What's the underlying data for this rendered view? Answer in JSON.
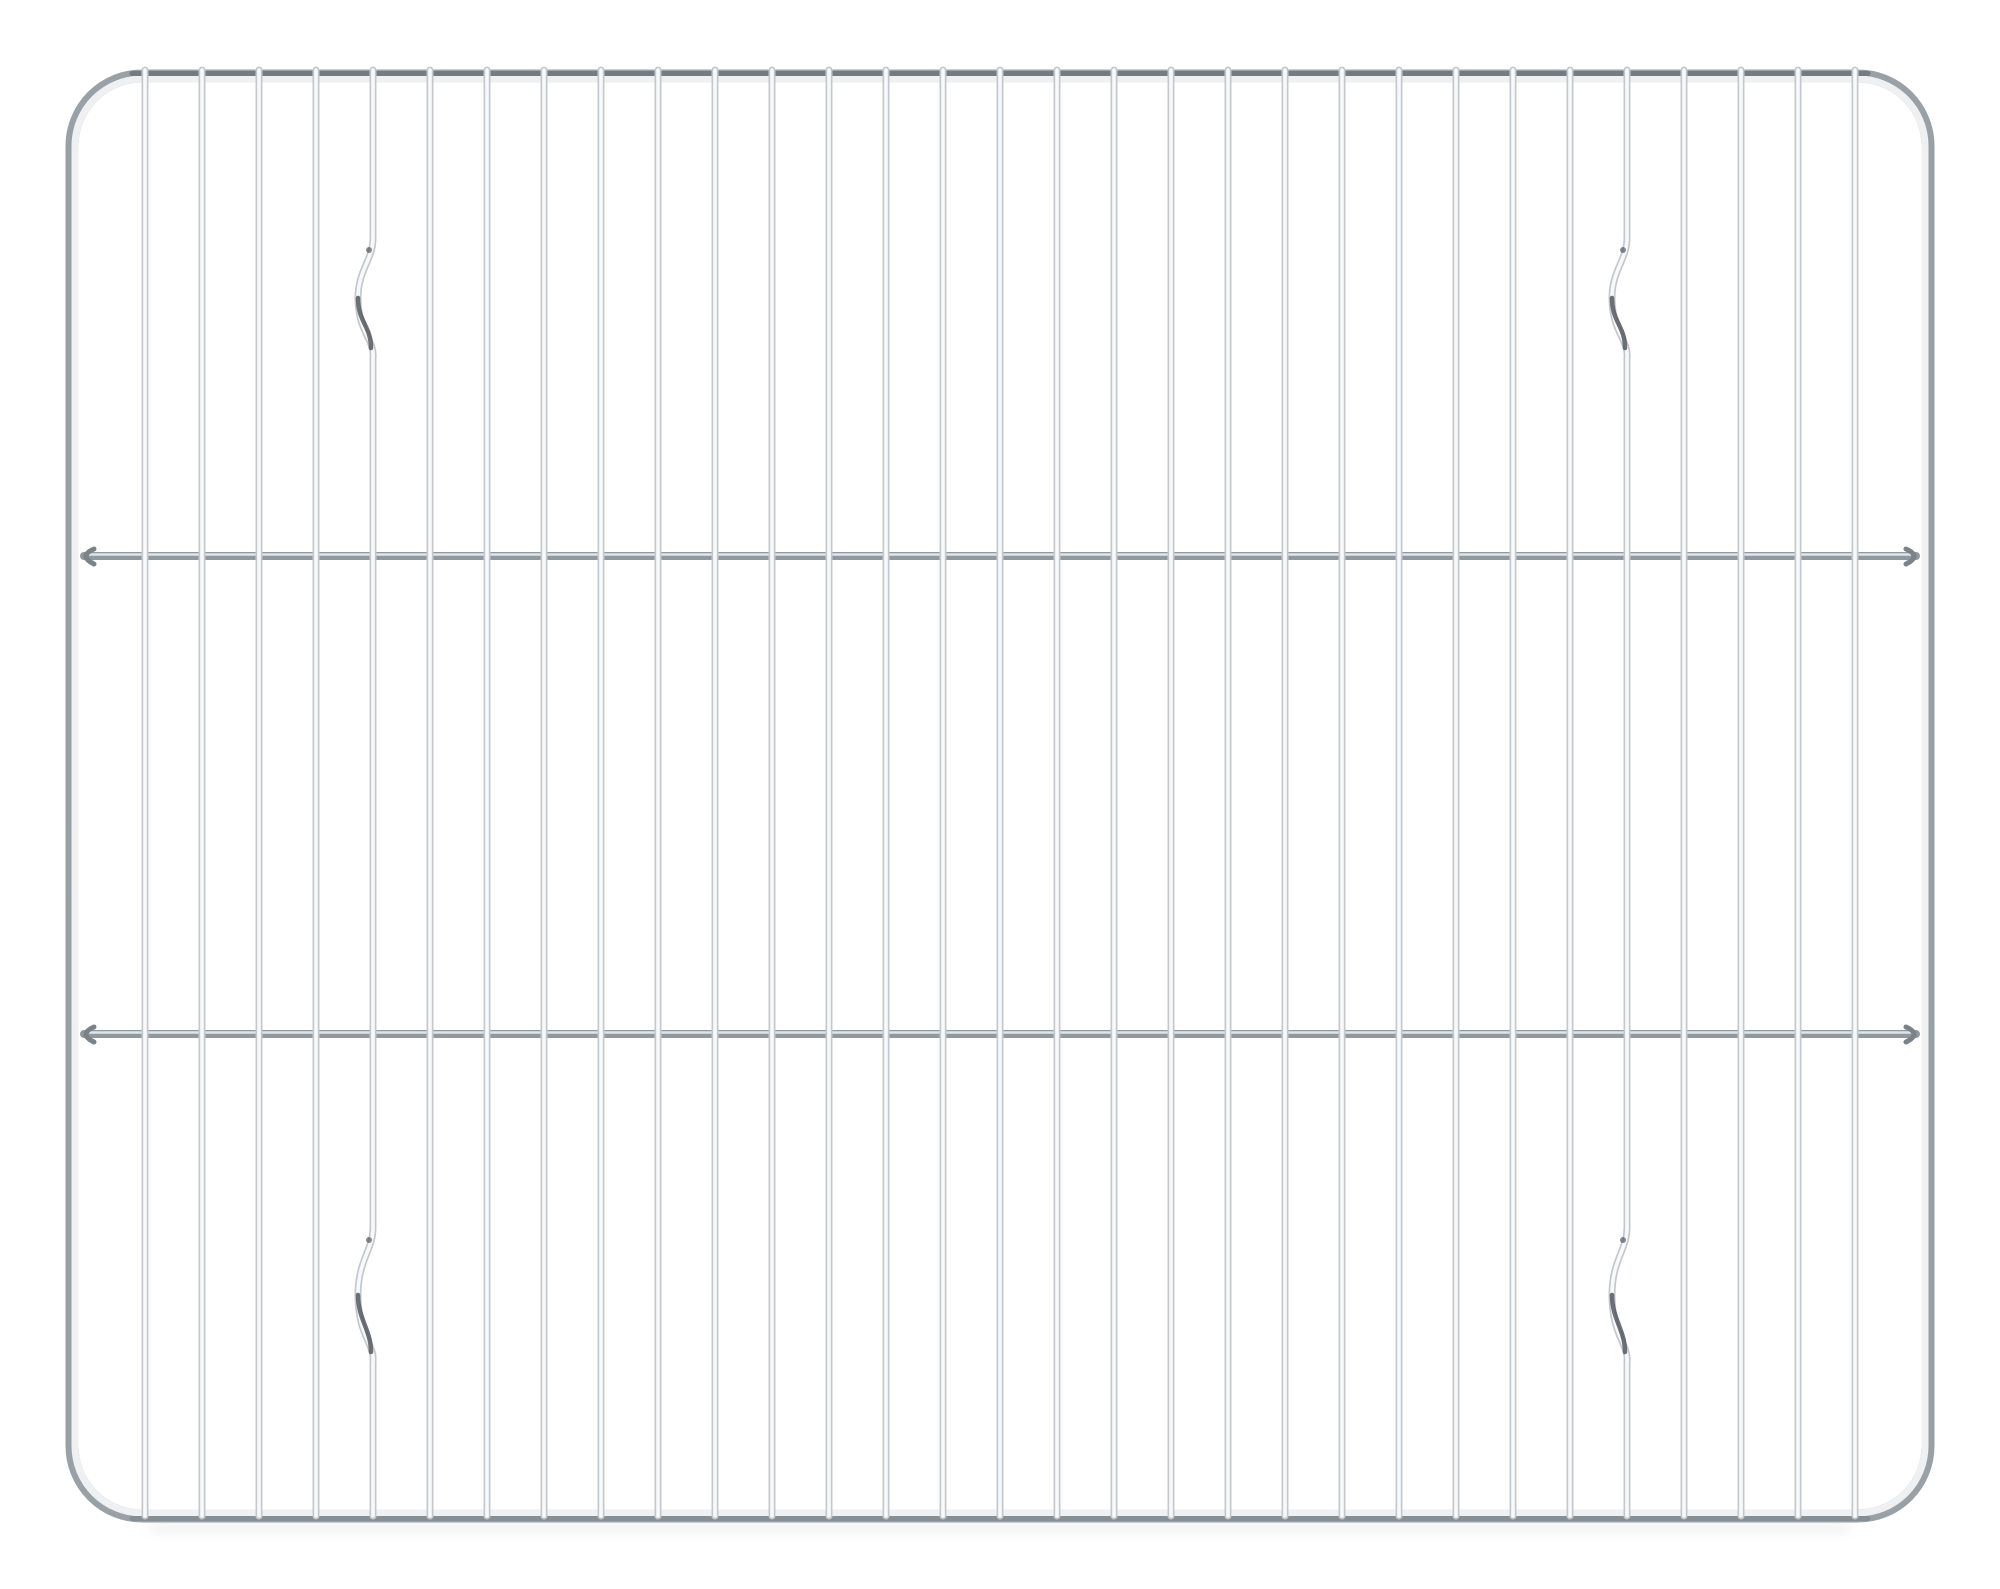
{
  "photo": {
    "subject": "chrome-wire-cooling-rack",
    "background_color": "#ffffff",
    "canvas": {
      "width": 2000,
      "height": 1589
    },
    "frame": {
      "x": 72,
      "y": 76,
      "w": 1856,
      "h": 1440,
      "radius": 70,
      "outer_color": "#99a0a6",
      "outer_width": 13,
      "inner_color": "#eef0f2",
      "inner_width": 7,
      "top_rim_color": "#747b82",
      "top_rim_width": 5,
      "top_rim_y": 73.5,
      "bottom_rim_color": "#878e94",
      "bottom_rim_width": 5,
      "bottom_rim_y": 1518.5,
      "rim_x1": 132,
      "rim_x2": 1868
    },
    "vertical_wires": {
      "count": 31,
      "first_x": 145,
      "spacing": 57,
      "top_y": 70,
      "bottom_y": 1516,
      "edge_color": "#c4c8cc",
      "edge_width": 7,
      "core_color": "#f8f9fa",
      "core_width": 3.6,
      "kinked_indices": [
        4,
        26
      ],
      "kink_top": {
        "start": 238,
        "end": 358,
        "depth": 15
      },
      "kink_bottom": {
        "start": 1228,
        "end": 1362,
        "depth": 15
      },
      "kink_glint_color": "#53585e",
      "kink_glint_width": 4.5
    },
    "crossbars": {
      "ys": [
        556,
        1034
      ],
      "x1": 84,
      "x2": 1916,
      "base_color": "#9099a0",
      "base_width": 8,
      "highlight_color": "#e2e5e7",
      "highlight_width": 2.6,
      "hook_color": "#7b8288",
      "hook_width": 5
    },
    "shadow": {
      "color": "#b3b8bc",
      "opacity": 0.2,
      "x": 150,
      "y": 1524,
      "w": 1700,
      "h": 9,
      "blur": 5
    }
  }
}
